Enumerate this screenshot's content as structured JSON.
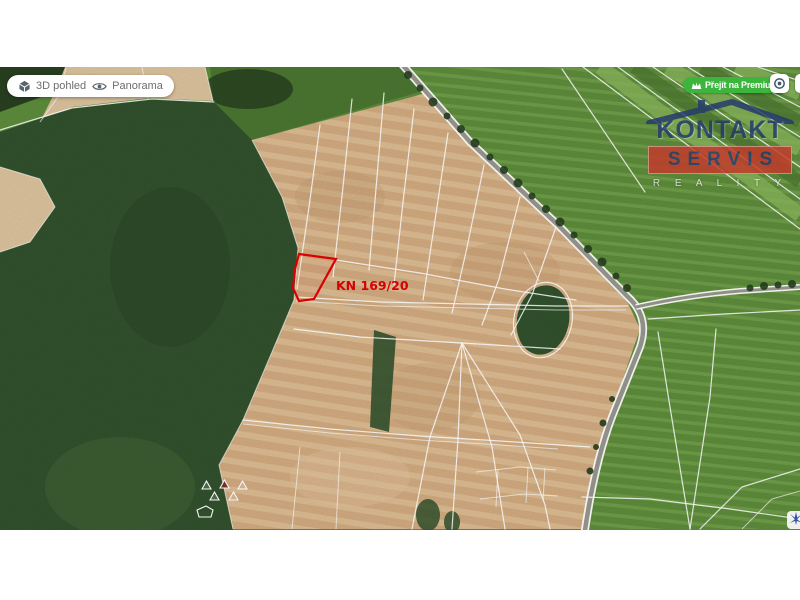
{
  "toolbar": {
    "view3d_label": "3D pohled",
    "panorama_label": "Panorama"
  },
  "premium_button": {
    "label": "Přejít na Premium"
  },
  "map": {
    "parcel_label": "KN 169/20"
  },
  "logo": {
    "title": "KONTAKT",
    "banner": "SERVIS",
    "subtitle": "R E A L I T Y"
  },
  "colors": {
    "premium": "#3cb53c",
    "parcelRed": "#e20000",
    "navy": "#253a6d",
    "logoRed": "#c33a2b",
    "forest": "#31502c",
    "forestDark": "#273f20",
    "tan": "#cfa87e",
    "tanLight": "#e3c9a2",
    "tanPale": "#d9c09b",
    "green": "#5c8a3b",
    "greenLight": "#8db85e",
    "greenDark": "#4a7430",
    "road": "#96958d",
    "line": "#ffffff",
    "uiText": "#6d6d6d",
    "pinBlue": "#3558a8"
  }
}
